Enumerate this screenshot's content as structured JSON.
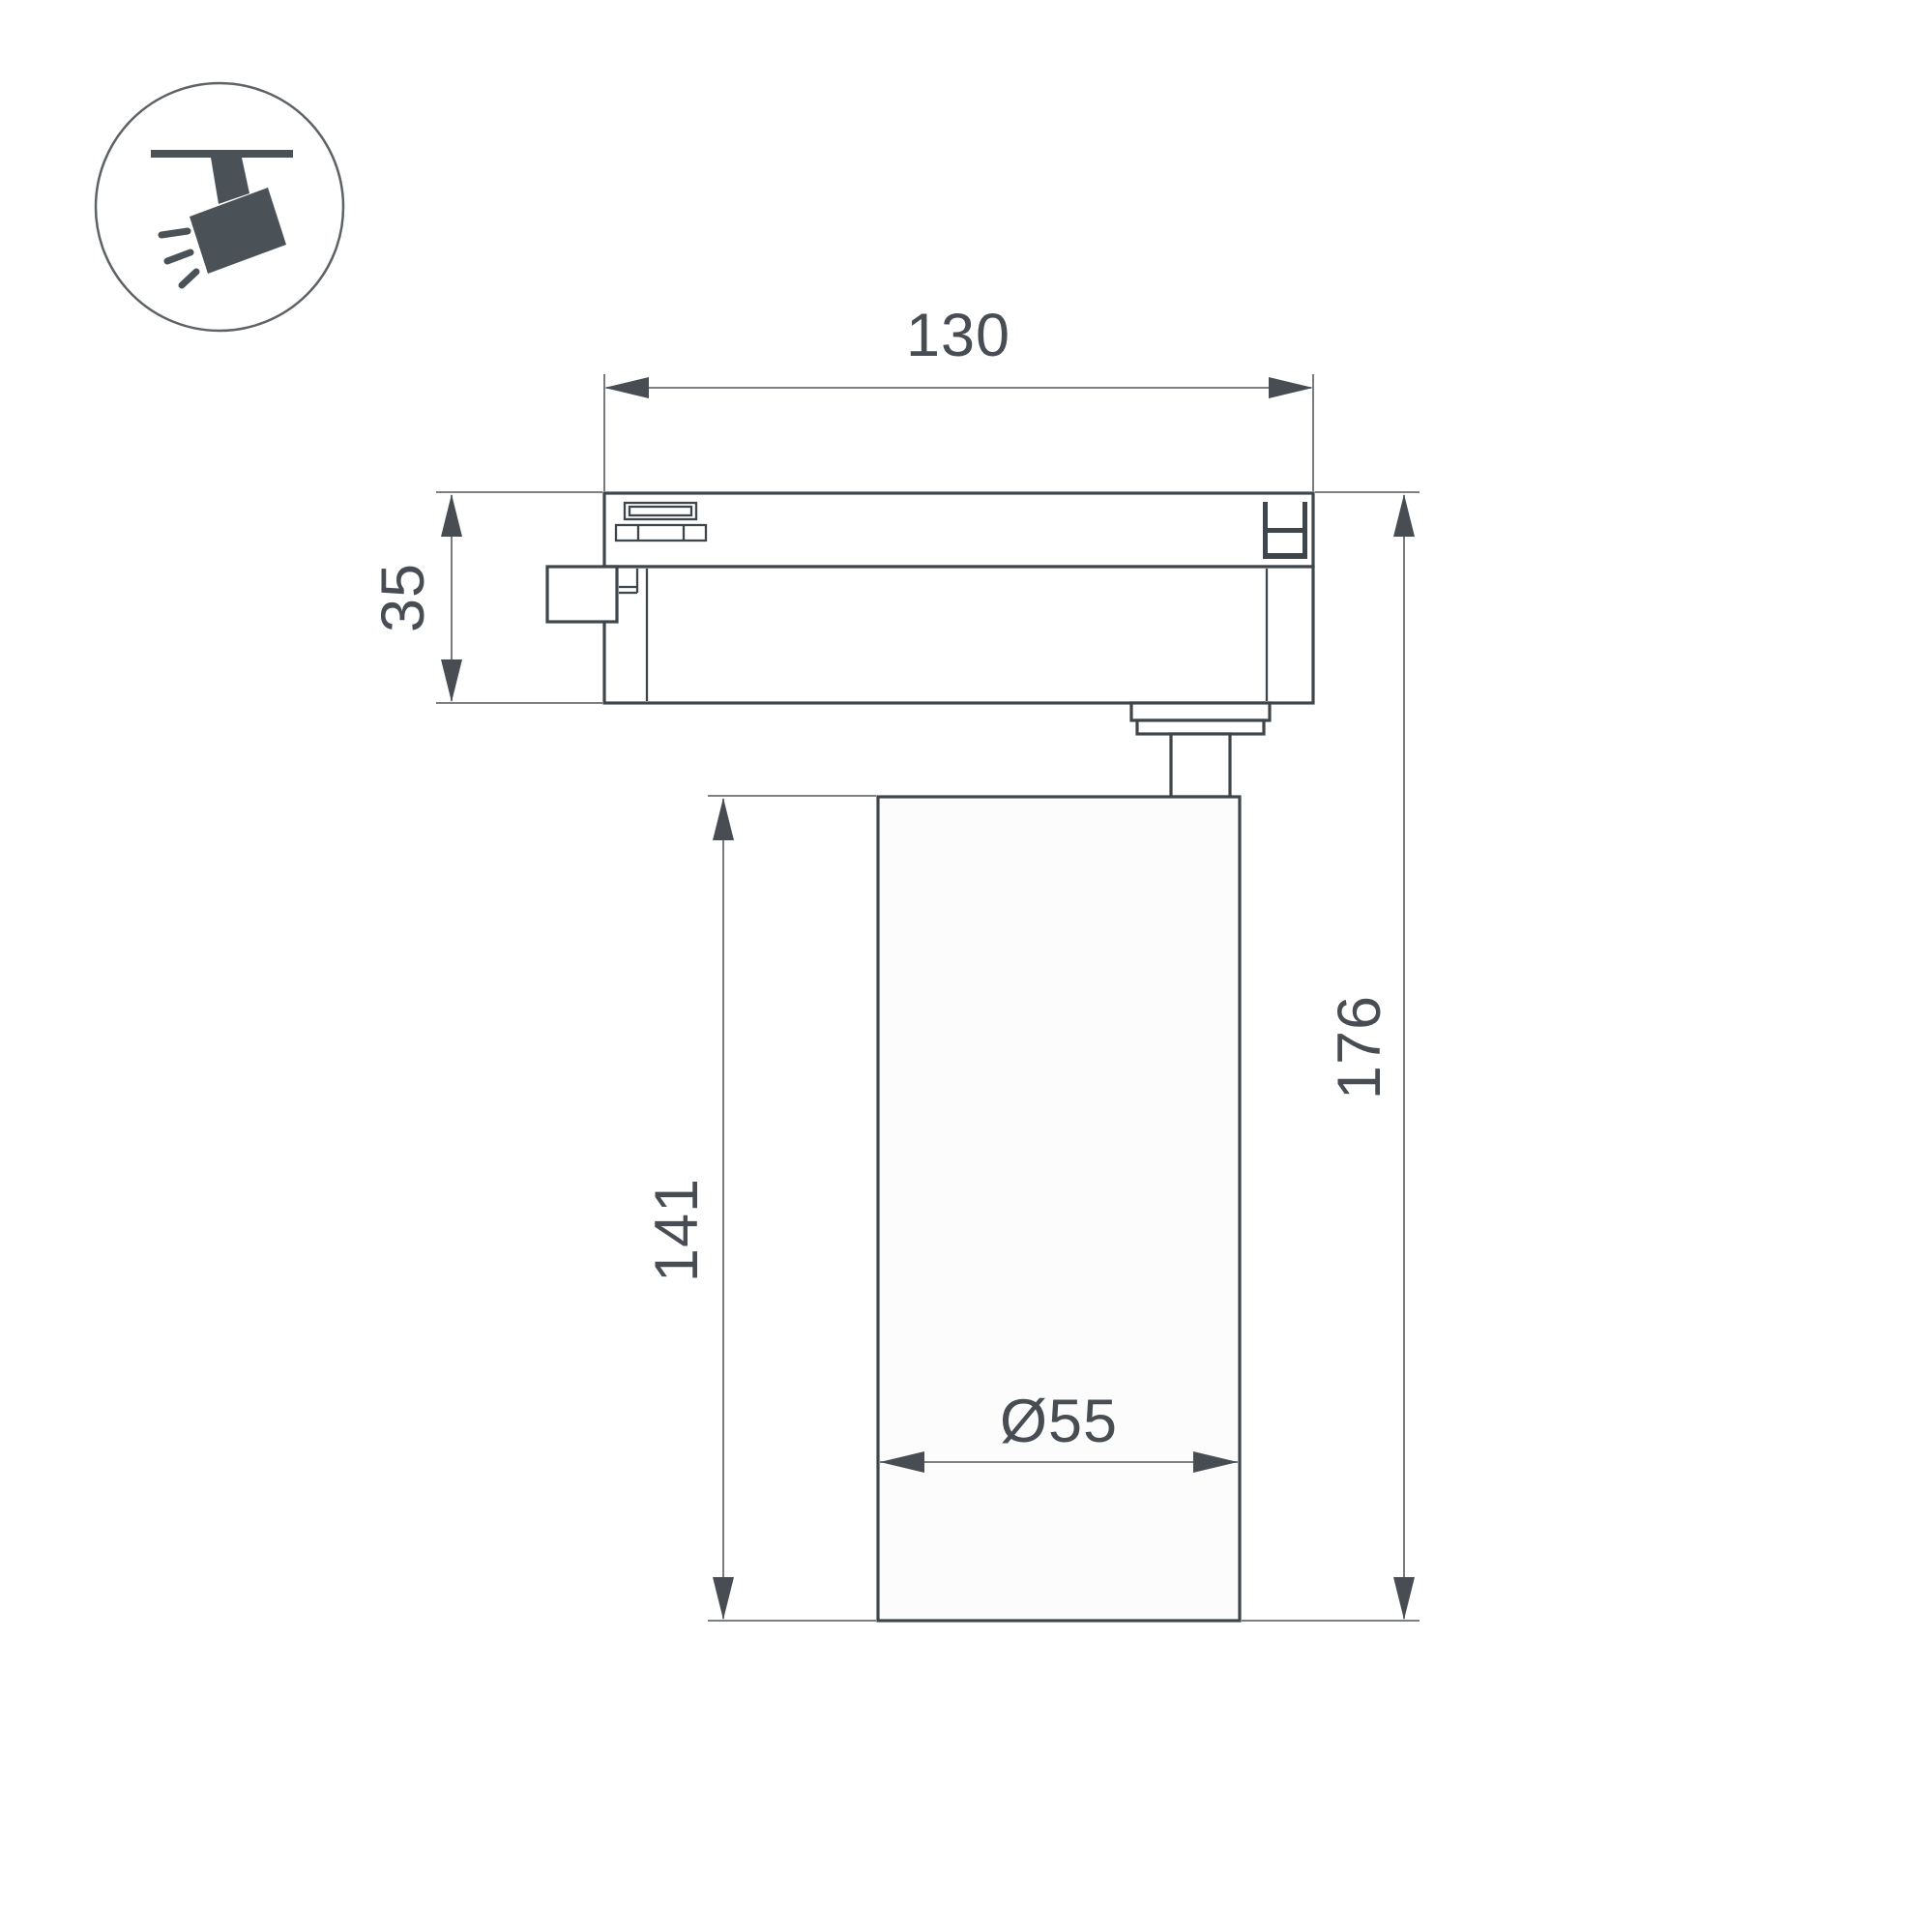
{
  "icon": {
    "name": "track-spotlight-icon"
  },
  "dimensions": {
    "track_width": {
      "label": "130"
    },
    "track_height": {
      "label": "35"
    },
    "body_height": {
      "label": "141"
    },
    "total_height": {
      "label": "176"
    },
    "body_diameter": {
      "label": "Ø55"
    }
  },
  "colors": {
    "background": "#ffffff",
    "outline": "#3f464b",
    "dimension": "#696e73",
    "text": "#474d52",
    "icon": "#4a5157"
  }
}
